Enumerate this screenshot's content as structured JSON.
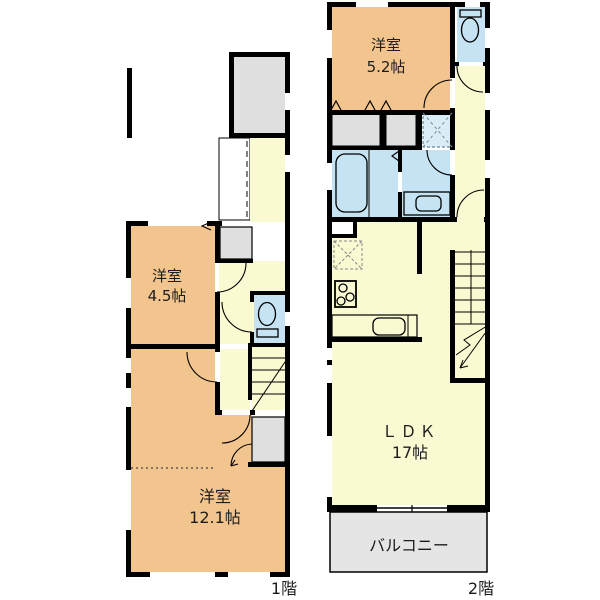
{
  "plan_type": "floorplan",
  "floors": [
    {
      "id": "floor-1",
      "label": "1階",
      "rooms": [
        {
          "name": "洋室",
          "size": "4.5帖"
        },
        {
          "name": "洋室",
          "size": "12.1帖"
        }
      ]
    },
    {
      "id": "floor-2",
      "label": "2階",
      "rooms": [
        {
          "name": "洋室",
          "size": "5.2帖"
        },
        {
          "name": "ＬＤＫ",
          "size": "17帖"
        },
        {
          "name": "バルコニー"
        }
      ]
    }
  ],
  "colors": {
    "room": "#F2C48E",
    "hall": "#FAFAD2",
    "wet": "#C5E3F2",
    "wet_light": "#DAEDF6",
    "closet": "#DFDFDF",
    "porch": "#DFDFDF",
    "balcony": "#E5E5E5",
    "entrance": "#FFFFFF",
    "wall": "#000000"
  },
  "icon_names": [
    "toilet-icon",
    "bathtub-icon",
    "washbasin-icon",
    "stove-icon",
    "kitchen-sink-icon",
    "washer-pan-icon",
    "refrigerator-space-icon",
    "stairs-icon",
    "door-swing-arc",
    "closet-fold-mark"
  ]
}
